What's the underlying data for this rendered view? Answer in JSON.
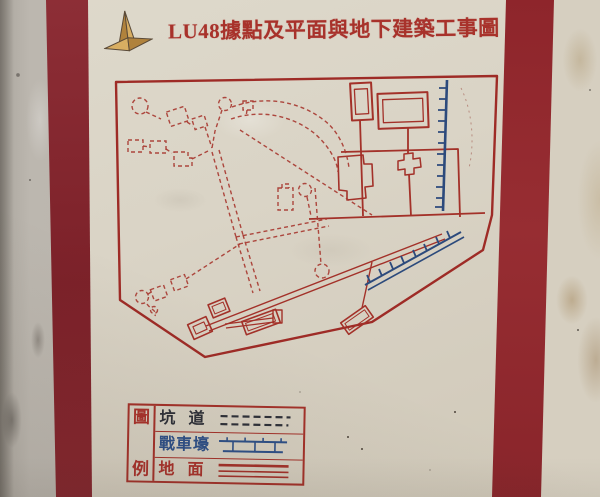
{
  "title": {
    "text": "LU48據點及平面與地下建築工事圖"
  },
  "legend": {
    "header_chars": {
      "top": "圖",
      "bottom": "例"
    },
    "rows": [
      {
        "label": "坑道",
        "symbol": "dashed-double-line"
      },
      {
        "label": "戰車壕",
        "symbol": "ticked-trench-line"
      },
      {
        "label": "地面",
        "symbol": "triple-solid-line"
      }
    ]
  },
  "colors": {
    "map_red": "#9e2b26",
    "tunnel_red": "#a83a31",
    "trench_blue": "#2c4a7c",
    "frame_maroon": "#85242c",
    "panel_cream": "#d8d2c4",
    "title_red": "#a8322b",
    "ink_dark": "#2e3038"
  }
}
